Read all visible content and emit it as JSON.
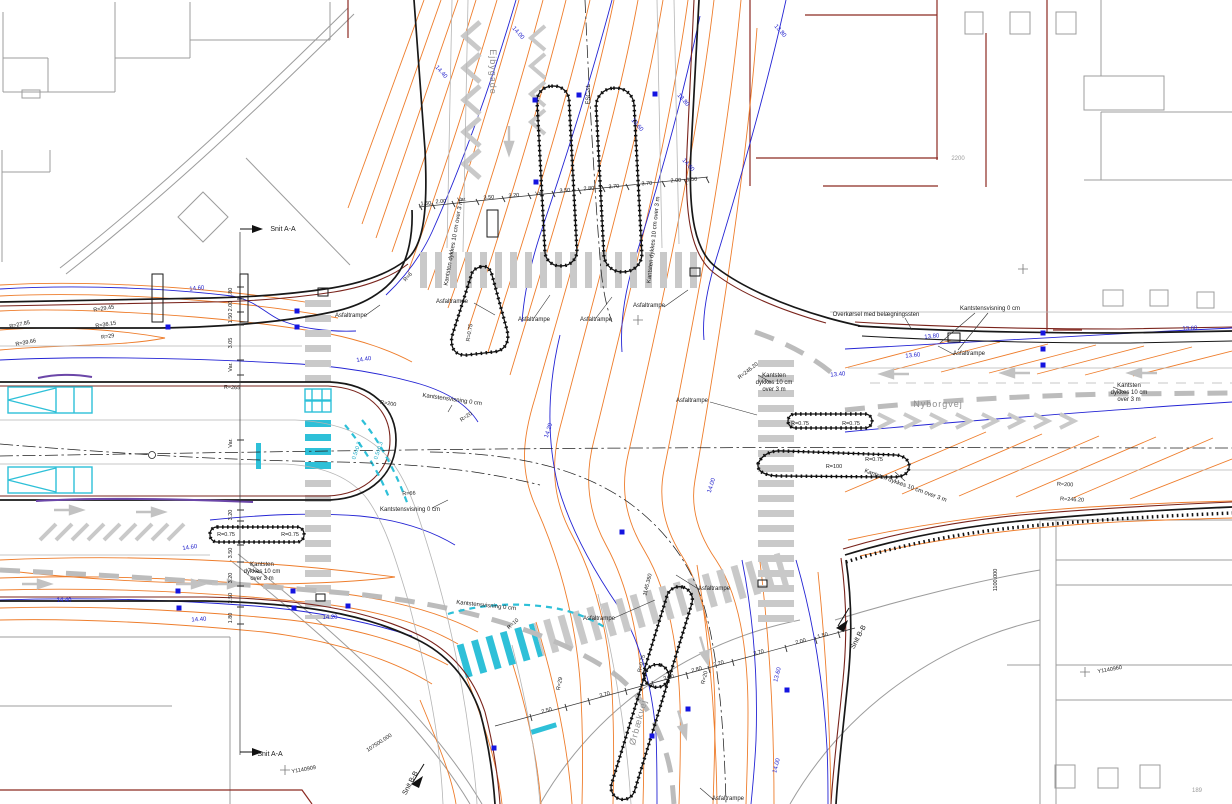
{
  "plan": {
    "road_names": {
      "north_leg": "Ejbygade",
      "east_leg": "Nyborgvej",
      "south_leg": "Ørbækvej"
    },
    "sheet_number": "189",
    "parcel_number": "2200",
    "section_marks": [
      "Snit A-A",
      "Snit B-B"
    ],
    "colors": {
      "existing_contour": "#ee7d2c",
      "proposed_contour": "#2424d4",
      "curb": "#181818",
      "property_line": "#7a241c",
      "light_rail": "#2ec0d8",
      "marking_gray": "#c9c9c9",
      "drain_symbol": "#1414e0"
    },
    "labels": [
      {
        "t": "Snit A-A",
        "x": 283,
        "y": 231,
        "r": 0,
        "c": "k7"
      },
      {
        "t": "Snit A-A",
        "x": 270,
        "y": 756,
        "r": 0,
        "c": "k7"
      },
      {
        "t": "Snit B-B",
        "x": 860,
        "y": 638,
        "r": -62,
        "c": "k7"
      },
      {
        "t": "Snit B-B",
        "x": 412,
        "y": 784,
        "r": -62,
        "c": "k7"
      },
      {
        "t": "Ejbygade",
        "x": 490,
        "y": 72,
        "r": 90,
        "c": "road"
      },
      {
        "t": "Nyborgvej",
        "x": 938,
        "y": 407,
        "r": 0,
        "c": "road"
      },
      {
        "t": "Ørbækvej",
        "x": 641,
        "y": 723,
        "r": -75,
        "c": "road"
      },
      {
        "t": "Asfaltrampe",
        "x": 452,
        "y": 303,
        "r": 0,
        "c": "k6"
      },
      {
        "t": "Asfaltrampe",
        "x": 351,
        "y": 317,
        "r": 0,
        "c": "k6"
      },
      {
        "t": "Asfaltrampe",
        "x": 534,
        "y": 321,
        "r": 0,
        "c": "k6"
      },
      {
        "t": "Asfaltrampe",
        "x": 596,
        "y": 321,
        "r": 0,
        "c": "k6"
      },
      {
        "t": "Asfaltrampe",
        "x": 649,
        "y": 307,
        "r": 0,
        "c": "k6"
      },
      {
        "t": "Asfaltrampe",
        "x": 692,
        "y": 402,
        "r": 0,
        "c": "k6"
      },
      {
        "t": "Asfaltrampe",
        "x": 969,
        "y": 355,
        "r": 0,
        "c": "k6"
      },
      {
        "t": "Asfaltrampe",
        "x": 599,
        "y": 620,
        "r": 0,
        "c": "k6"
      },
      {
        "t": "Asfaltrampe",
        "x": 714,
        "y": 590,
        "r": 0,
        "c": "k6"
      },
      {
        "t": "Asfaltrampe",
        "x": 728,
        "y": 800,
        "r": 0,
        "c": "k6"
      },
      {
        "t": "Kantstensvisning 0 cm",
        "x": 452,
        "y": 401,
        "r": 8,
        "c": "k6"
      },
      {
        "t": "Kantstensvisning 0 cm",
        "x": 410,
        "y": 511,
        "r": 0,
        "c": "k6"
      },
      {
        "t": "Kantstensvisning 0 cm",
        "x": 486,
        "y": 607,
        "r": 6,
        "c": "k6"
      },
      {
        "t": "Kantstensvisning 0 cm",
        "x": 990,
        "y": 310,
        "r": 0,
        "c": "k6"
      },
      {
        "t": "Overkørsel med belægningssten",
        "x": 876,
        "y": 316,
        "r": 0,
        "c": "k6"
      },
      {
        "t": "Kantsten",
        "x": 774,
        "y": 377,
        "r": 0,
        "c": "k6",
        "a": "s"
      },
      {
        "t": "dykkes 10 cm",
        "x": 774,
        "y": 384,
        "r": 0,
        "c": "k6",
        "a": "s"
      },
      {
        "t": "over 3 m",
        "x": 774,
        "y": 391,
        "r": 0,
        "c": "k6",
        "a": "s"
      },
      {
        "t": "Kantsten",
        "x": 1129,
        "y": 387,
        "r": 0,
        "c": "k6",
        "a": "s"
      },
      {
        "t": "dykkes 10 cm",
        "x": 1129,
        "y": 394,
        "r": 0,
        "c": "k6",
        "a": "s"
      },
      {
        "t": "over 3 m",
        "x": 1129,
        "y": 401,
        "r": 0,
        "c": "k6",
        "a": "s"
      },
      {
        "t": "Kantsten",
        "x": 262,
        "y": 566,
        "r": 0,
        "c": "k6",
        "a": "s"
      },
      {
        "t": "dykkes 10 cm",
        "x": 262,
        "y": 573,
        "r": 0,
        "c": "k6",
        "a": "s"
      },
      {
        "t": "over 3 m",
        "x": 262,
        "y": 580,
        "r": 0,
        "c": "k6",
        "a": "s"
      },
      {
        "t": "Kantsten dykkes 10 cm over 3 m",
        "x": 455,
        "y": 243,
        "r": -80,
        "c": "k6"
      },
      {
        "t": "Kantsten dykkes 10 cm over 3 m",
        "x": 655,
        "y": 240,
        "r": -84,
        "c": "k6"
      },
      {
        "t": "Kantsten dykkes 10 cm over 3 m",
        "x": 905,
        "y": 487,
        "r": 20,
        "c": "k6"
      },
      {
        "t": "2200",
        "x": 958,
        "y": 160,
        "r": 0,
        "c": "gy"
      },
      {
        "t": "189",
        "x": 1197,
        "y": 792,
        "r": 0,
        "c": "gy"
      },
      {
        "t": "FSC-st",
        "x": 590,
        "y": 95,
        "r": -90,
        "c": "k6"
      },
      {
        "t": "0.5±0.3",
        "x": 358,
        "y": 451,
        "r": -72,
        "c": "cy"
      },
      {
        "t": "0.5±0.3",
        "x": 380,
        "y": 451,
        "r": -72,
        "c": "cy"
      },
      {
        "t": "14.60",
        "x": 197,
        "y": 290,
        "r": -6,
        "c": "bl"
      },
      {
        "t": "14.40",
        "x": 364,
        "y": 361,
        "r": -8,
        "c": "bl"
      },
      {
        "t": "14.40",
        "x": 440,
        "y": 73,
        "r": 48,
        "c": "bl"
      },
      {
        "t": "14.00",
        "x": 517,
        "y": 34,
        "r": 48,
        "c": "bl"
      },
      {
        "t": "13.80",
        "x": 682,
        "y": 101,
        "r": 48,
        "c": "bl"
      },
      {
        "t": "13.60",
        "x": 636,
        "y": 126,
        "r": 48,
        "c": "bl"
      },
      {
        "t": "14.60",
        "x": 687,
        "y": 166,
        "r": 48,
        "c": "bl"
      },
      {
        "t": "13.80",
        "x": 779,
        "y": 32,
        "r": 48,
        "c": "bl"
      },
      {
        "t": "14.20",
        "x": 550,
        "y": 431,
        "r": -72,
        "c": "bl"
      },
      {
        "t": "14.00",
        "x": 713,
        "y": 486,
        "r": -72,
        "c": "bl"
      },
      {
        "t": "13.80",
        "x": 932,
        "y": 338,
        "r": -6,
        "c": "bl"
      },
      {
        "t": "13.60",
        "x": 913,
        "y": 357,
        "r": -6,
        "c": "bl"
      },
      {
        "t": "13.40",
        "x": 838,
        "y": 376,
        "r": -5,
        "c": "bl"
      },
      {
        "t": "14.60",
        "x": 190,
        "y": 549,
        "r": -8,
        "c": "bl"
      },
      {
        "t": "14.40",
        "x": 64,
        "y": 602,
        "r": 0,
        "c": "bl"
      },
      {
        "t": "14.40",
        "x": 199,
        "y": 621,
        "r": -4,
        "c": "bl"
      },
      {
        "t": "14.20",
        "x": 330,
        "y": 619,
        "r": 0,
        "c": "bl"
      },
      {
        "t": "13.60",
        "x": 779,
        "y": 675,
        "r": -76,
        "c": "bl"
      },
      {
        "t": "14.00",
        "x": 778,
        "y": 766,
        "r": -76,
        "c": "bl"
      },
      {
        "t": "13.60",
        "x": 1190,
        "y": 330,
        "r": -3,
        "c": "bl"
      },
      {
        "t": "R=27.85",
        "x": 20,
        "y": 326,
        "r": -12,
        "c": "k55"
      },
      {
        "t": "R=29.45",
        "x": 104,
        "y": 310,
        "r": -9,
        "c": "k55"
      },
      {
        "t": "R=36.15",
        "x": 106,
        "y": 326,
        "r": -9,
        "c": "k55"
      },
      {
        "t": "R=39.66",
        "x": 26,
        "y": 344,
        "r": -10,
        "c": "k55"
      },
      {
        "t": "R=29",
        "x": 108,
        "y": 338,
        "r": -9,
        "c": "k55"
      },
      {
        "t": "R=265",
        "x": 232,
        "y": 389,
        "r": 2,
        "c": "k55"
      },
      {
        "t": "R=200",
        "x": 388,
        "y": 405,
        "r": 9,
        "c": "k55"
      },
      {
        "t": "R=66",
        "x": 409,
        "y": 495,
        "r": -3,
        "c": "k55"
      },
      {
        "t": "R=20",
        "x": 467,
        "y": 418,
        "r": -35,
        "c": "k55"
      },
      {
        "t": "R=0.75",
        "x": 471,
        "y": 333,
        "r": -80,
        "c": "k55"
      },
      {
        "t": "R=6",
        "x": 409,
        "y": 278,
        "r": -48,
        "c": "k55"
      },
      {
        "t": "R=0.75",
        "x": 800,
        "y": 425,
        "r": 0,
        "c": "k55"
      },
      {
        "t": "R=0.75",
        "x": 851,
        "y": 425,
        "r": 0,
        "c": "k55"
      },
      {
        "t": "R=100",
        "x": 834,
        "y": 468,
        "r": 0,
        "c": "k55"
      },
      {
        "t": "R=0.75",
        "x": 874,
        "y": 461,
        "r": 0,
        "c": "k55"
      },
      {
        "t": "R=0.75",
        "x": 226,
        "y": 536,
        "r": 0,
        "c": "k55"
      },
      {
        "t": "R=0.75",
        "x": 290,
        "y": 536,
        "r": 0,
        "c": "k55"
      },
      {
        "t": "R=200",
        "x": 1065,
        "y": 486,
        "r": 3,
        "c": "k55"
      },
      {
        "t": "R=246.20",
        "x": 1072,
        "y": 501,
        "r": 3,
        "c": "k55"
      },
      {
        "t": "R=246.20",
        "x": 749,
        "y": 372,
        "r": -38,
        "c": "k55"
      },
      {
        "t": "R=10",
        "x": 514,
        "y": 625,
        "r": -42,
        "c": "k55"
      },
      {
        "t": "R=29",
        "x": 561,
        "y": 684,
        "r": -78,
        "c": "k55"
      },
      {
        "t": "R=0.75",
        "x": 643,
        "y": 664,
        "r": -76,
        "c": "k55"
      },
      {
        "t": "R=20",
        "x": 706,
        "y": 678,
        "r": -76,
        "c": "k55"
      },
      {
        "t": "1.50",
        "x": 426,
        "y": 205,
        "r": -4,
        "c": "k55"
      },
      {
        "t": "2.00",
        "x": 441,
        "y": 203,
        "r": -4,
        "c": "k55"
      },
      {
        "t": "Var.",
        "x": 462,
        "y": 201,
        "r": -4,
        "c": "k55"
      },
      {
        "t": "3.50",
        "x": 489,
        "y": 199,
        "r": -4,
        "c": "k55"
      },
      {
        "t": "3.20",
        "x": 514,
        "y": 197,
        "r": -4,
        "c": "k55"
      },
      {
        "t": "Var.",
        "x": 540,
        "y": 195,
        "r": -4,
        "c": "k55"
      },
      {
        "t": "3.50",
        "x": 565,
        "y": 192,
        "r": -4,
        "c": "k55"
      },
      {
        "t": "2.80",
        "x": 589,
        "y": 190,
        "r": -4,
        "c": "k55"
      },
      {
        "t": "3.70",
        "x": 614,
        "y": 188,
        "r": -4,
        "c": "k55"
      },
      {
        "t": "3.70",
        "x": 647,
        "y": 185,
        "r": -4,
        "c": "k55"
      },
      {
        "t": "2.00",
        "x": 676,
        "y": 182,
        "r": -4,
        "c": "k55"
      },
      {
        "t": "1.50",
        "x": 692,
        "y": 181,
        "r": -4,
        "c": "k55"
      },
      {
        "t": "1.80",
        "x": 232,
        "y": 293,
        "r": -90,
        "c": "k55"
      },
      {
        "t": "2.00",
        "x": 232,
        "y": 306,
        "r": -90,
        "c": "k55"
      },
      {
        "t": "1.50",
        "x": 232,
        "y": 318,
        "r": -90,
        "c": "k55"
      },
      {
        "t": "3.05",
        "x": 232,
        "y": 343,
        "r": -90,
        "c": "k55"
      },
      {
        "t": "Var.",
        "x": 232,
        "y": 367,
        "r": -90,
        "c": "k55"
      },
      {
        "t": "Var.",
        "x": 232,
        "y": 443,
        "r": -90,
        "c": "k55"
      },
      {
        "t": "3.20",
        "x": 232,
        "y": 515,
        "r": -90,
        "c": "k55"
      },
      {
        "t": "3.50",
        "x": 232,
        "y": 553,
        "r": -90,
        "c": "k55"
      },
      {
        "t": "3.20",
        "x": 232,
        "y": 578,
        "r": -90,
        "c": "k55"
      },
      {
        "t": "2.50",
        "x": 232,
        "y": 598,
        "r": -90,
        "c": "k55"
      },
      {
        "t": "1.80",
        "x": 232,
        "y": 618,
        "r": -90,
        "c": "k55"
      },
      {
        "t": "2.50",
        "x": 547,
        "y": 712,
        "r": -15,
        "c": "k55"
      },
      {
        "t": "3.70",
        "x": 605,
        "y": 696,
        "r": -15,
        "c": "k55"
      },
      {
        "t": "3.50",
        "x": 669,
        "y": 679,
        "r": -15,
        "c": "k55"
      },
      {
        "t": "2.80",
        "x": 697,
        "y": 671,
        "r": -15,
        "c": "k55"
      },
      {
        "t": "3.20",
        "x": 719,
        "y": 665,
        "r": -15,
        "c": "k55"
      },
      {
        "t": "3.70",
        "x": 759,
        "y": 654,
        "r": -15,
        "c": "k55"
      },
      {
        "t": "2.00",
        "x": 801,
        "y": 643,
        "r": -15,
        "c": "k55"
      },
      {
        "t": "1.50",
        "x": 823,
        "y": 637,
        "r": -15,
        "c": "k55"
      },
      {
        "t": "1145.360",
        "x": 649,
        "y": 585,
        "r": -76,
        "c": "k55"
      },
      {
        "t": "1100.000",
        "x": 997,
        "y": 580,
        "r": -90,
        "c": "k55"
      },
      {
        "t": "107500.000",
        "x": 380,
        "y": 744,
        "r": -33,
        "c": "k55"
      },
      {
        "t": "Y1140909",
        "x": 304,
        "y": 771,
        "r": -10,
        "c": "k55"
      },
      {
        "t": "Y1140960",
        "x": 1110,
        "y": 671,
        "r": -10,
        "c": "k55"
      }
    ],
    "drain_inlets": [
      [
        536,
        182
      ],
      [
        579,
        95
      ],
      [
        655,
        94
      ],
      [
        535,
        100
      ],
      [
        168,
        327
      ],
      [
        297,
        311
      ],
      [
        297,
        327
      ],
      [
        178,
        591
      ],
      [
        179,
        608
      ],
      [
        293,
        591
      ],
      [
        294,
        608
      ],
      [
        348,
        606
      ],
      [
        1043,
        333
      ],
      [
        1043,
        349
      ],
      [
        1043,
        365
      ],
      [
        688,
        709
      ],
      [
        652,
        736
      ],
      [
        494,
        748
      ],
      [
        787,
        690
      ],
      [
        622,
        532
      ]
    ],
    "grid_crosses": [
      [
        638,
        320
      ],
      [
        1023,
        269
      ],
      [
        285,
        770
      ],
      [
        1085,
        672
      ]
    ]
  }
}
